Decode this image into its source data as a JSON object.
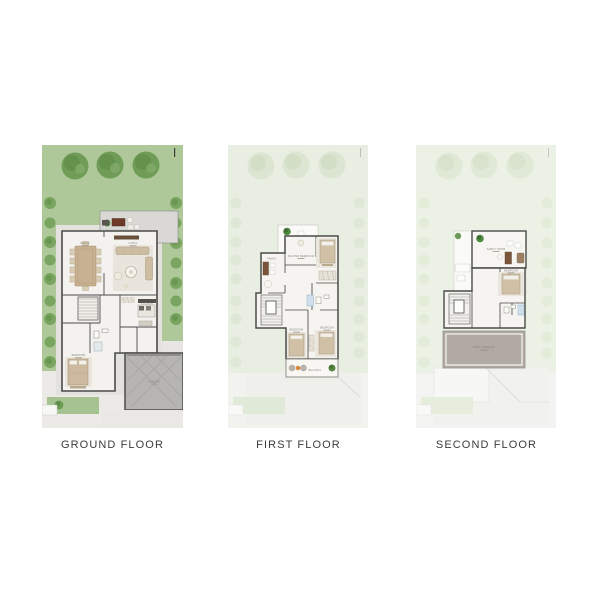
{
  "page": {
    "background": "#ffffff"
  },
  "floors": [
    {
      "id": "ground-floor",
      "label": "GROUND FLOOR",
      "rooms": {
        "dining": "DINING",
        "living": "LIVING",
        "kitchen": "KITCHEN",
        "bedroom": "BEDROOM",
        "garage": "GARAGE"
      }
    },
    {
      "id": "first-floor",
      "label": "FIRST FLOOR",
      "rooms": {
        "master_bedroom": "MASTER BEDROOM",
        "lounge": "FAMILY",
        "bedroom_left": "BEDROOM",
        "bedroom_right": "BEDROOM",
        "balcony": "BALCONY"
      }
    },
    {
      "id": "second-floor",
      "label": "SECOND FLOOR",
      "rooms": {
        "family": "FAMILY ROOM",
        "bedroom": "BEDROOM",
        "roof_terrace": "ROOF TERRACE"
      }
    }
  ],
  "palette": {
    "lawn_green": "#aec89a",
    "tree_green": "#6f9c57",
    "faded_green": "#e9eee3",
    "terrace_gray": "#d9d8d4",
    "garage_gray": "#b6b5b1",
    "roof_terrace_gray": "#b1aaa3",
    "wall_dark": "#4b4b49",
    "furniture_beige": "#ccbda3",
    "planter_orange": "#d98a3c",
    "label_color": "#3b3b3b"
  }
}
